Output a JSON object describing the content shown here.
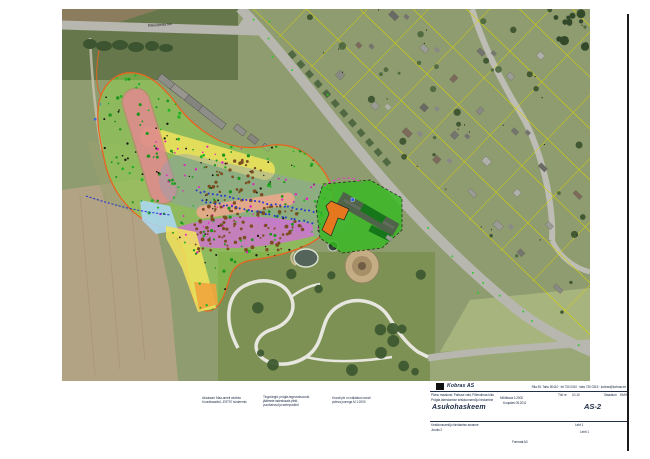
{
  "map": {
    "road_label": "Põlendmaa tee"
  },
  "notes": [
    {
      "lines": [
        "Aluskaart: Maa-ameti ortofoto",
        "Koordinaadid L-EST97 süsteemis"
      ]
    },
    {
      "lines": [
        "Tingmärgid: prügila tegevustsoonid,",
        "jäätmete ladestusala piirid,",
        "puurkaevud ja seirepunktid"
      ]
    },
    {
      "lines": [
        "Krundi piir on näidatud oranži",
        "pideva joonega   M 1:2000"
      ]
    }
  ],
  "title_block": {
    "company": "Kobras AS",
    "address": "Riia 35, Tartu 50410 · tel 730 0310 · faks 730 0315 · kobras@kobras.ee",
    "project_line1": "Pärnu maakond, Paikuse vald, Põlendmaa küla",
    "project_line2": "Prügila laiendamise keskkonnamõju hindamine",
    "sheet_title": "Asukohaskeem",
    "scale_label": "Mõõtkava 1:2000",
    "date_label": "Kuupäev 05.2011",
    "work_no_label": "Töö nr",
    "work_no": "10-10",
    "stage_label": "Staadium",
    "stage": "KMH",
    "drawing_no": "AS-2",
    "client_line1": "Keskkonnamõju hindamise aruanne",
    "client_line2": "Joonis 2",
    "sheet_label": "Leht 1",
    "sheets_label": "Lehti 1",
    "format_label": "Formaat A3"
  },
  "colors": {
    "ink": "#1c2b45",
    "site_outline": "#e8641e",
    "zone_green": "#8ede46",
    "zone_pink": "#e29090",
    "pink_edge": "#c97676",
    "zone_yellow": "#f2e45c",
    "zone_gray": "#8ea0b4",
    "zone_salmon": "#f0a98c",
    "zone_magenta": "#d869df",
    "zone_lightblue": "#abd6ef",
    "zone_orange": "#f0a53c",
    "facility_green": "#35bb1e",
    "facility_dark_green": "#15761a",
    "building_orange": "#e5771e",
    "parcel_yellow": "#d6d400",
    "road_gray": "#b7b7af",
    "path_white": "#e7e7df",
    "water": "#55645a",
    "dot_green": "#1d941d",
    "dot_green2": "#27b327",
    "dot_bright_green": "#22cc22",
    "dot_brown": "#7a4e22",
    "dot_blue": "#2a3acc",
    "dot_magenta": "#e020c0",
    "dot_black": "#15150f"
  }
}
